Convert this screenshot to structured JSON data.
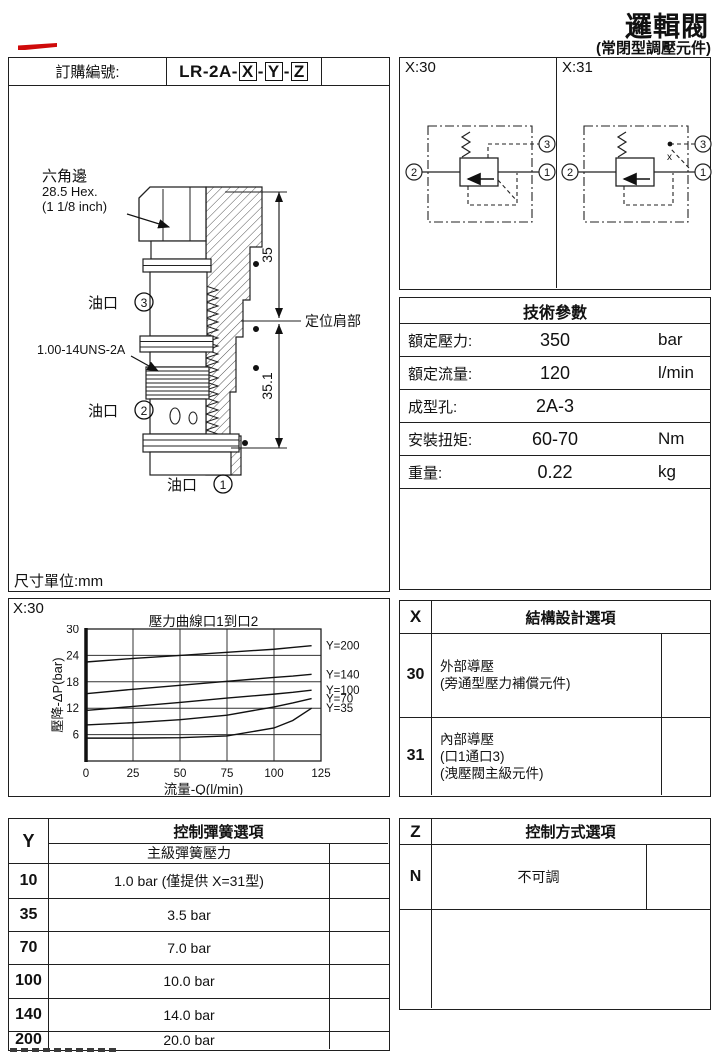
{
  "page": {
    "title": "邏輯閥",
    "subtitle": "(常閉型調壓元件)"
  },
  "order": {
    "label": "訂購編號:",
    "prefix": "LR-2A-",
    "x": "X",
    "y": "Y",
    "z": "Z",
    "sep": "-"
  },
  "drawing": {
    "hex_label_cn": "六角邊",
    "hex_size": "28.5 Hex.",
    "hex_inch": "(1 1/8 inch)",
    "thread_label": "1.00-14UNS-2A",
    "port_word3": "油口",
    "port_word2": "油口",
    "port_word1": "油口",
    "port1_num": "1",
    "port2_num": "2",
    "port3_num": "3",
    "dim_upper": "35",
    "dim_lower": "35.1",
    "shoulder_label": "定位肩部",
    "units_note": "尺寸單位:mm"
  },
  "schematics": {
    "left_label": "X:30",
    "right_label": "X:31",
    "port1": "1",
    "port2": "2",
    "port3": "3",
    "pilot_mark": "x"
  },
  "tech": {
    "title": "技術參數",
    "rows": [
      {
        "label": "額定壓力:",
        "value": "350",
        "unit": "bar"
      },
      {
        "label": "額定流量:",
        "value": "120",
        "unit": "l/min"
      },
      {
        "label": "成型孔:",
        "value": "2A-3",
        "unit": ""
      },
      {
        "label": "安裝扭矩:",
        "value": "60-70",
        "unit": "Nm"
      },
      {
        "label": "重量:",
        "value": "0.22",
        "unit": "kg"
      }
    ]
  },
  "chart_data": {
    "type": "line",
    "section_label": "X:30",
    "title": "壓力曲線口1到口2",
    "xlabel": "流量-Q(l/min)",
    "ylabel": "壓降-ΔP(bar)",
    "xlim": [
      0,
      125
    ],
    "ylim": [
      0,
      30
    ],
    "xticks": [
      0,
      25,
      50,
      75,
      100,
      125
    ],
    "yticks": [
      6,
      12,
      18,
      24,
      30
    ],
    "grid": true,
    "legend_position": "right-outside",
    "x": [
      0,
      25,
      50,
      75,
      100,
      110,
      120
    ],
    "series": [
      {
        "name": "Y=200",
        "y": [
          22.5,
          23.3,
          24.0,
          24.7,
          25.4,
          25.8,
          26.2
        ]
      },
      {
        "name": "Y=140",
        "y": [
          15.3,
          16.3,
          17.2,
          18.1,
          19.0,
          19.3,
          19.7
        ]
      },
      {
        "name": "Y=100",
        "y": [
          11.5,
          12.4,
          13.3,
          14.3,
          15.2,
          15.6,
          16.1
        ]
      },
      {
        "name": "Y=70",
        "y": [
          8.2,
          8.7,
          9.4,
          10.4,
          12.3,
          13.2,
          14.2
        ]
      },
      {
        "name": "Y=35",
        "y": [
          5.2,
          5.2,
          5.3,
          5.7,
          7.5,
          9.2,
          12.0
        ]
      }
    ]
  },
  "x_options": {
    "col": "X",
    "title": "結構設計選項",
    "rows": [
      {
        "code": "30",
        "lines": [
          "外部導壓",
          "(旁通型壓力補償元件)"
        ]
      },
      {
        "code": "31",
        "lines": [
          "內部導壓",
          "(口1通口3)",
          "(洩壓閥主級元件)"
        ]
      }
    ]
  },
  "y_options": {
    "col": "Y",
    "title": "控制彈簧選項",
    "subtitle": "主級彈簧壓力",
    "rows": [
      {
        "code": "10",
        "value": "1.0 bar  (僅提供 X=31型)"
      },
      {
        "code": "35",
        "value": "3.5 bar"
      },
      {
        "code": "70",
        "value": "7.0 bar"
      },
      {
        "code": "100",
        "value": "10.0 bar"
      },
      {
        "code": "140",
        "value": "14.0 bar"
      },
      {
        "code": "200",
        "value": "20.0 bar"
      }
    ]
  },
  "z_options": {
    "col": "Z",
    "title": "控制方式選項",
    "rows": [
      {
        "code": "N",
        "value": "不可調"
      }
    ]
  }
}
